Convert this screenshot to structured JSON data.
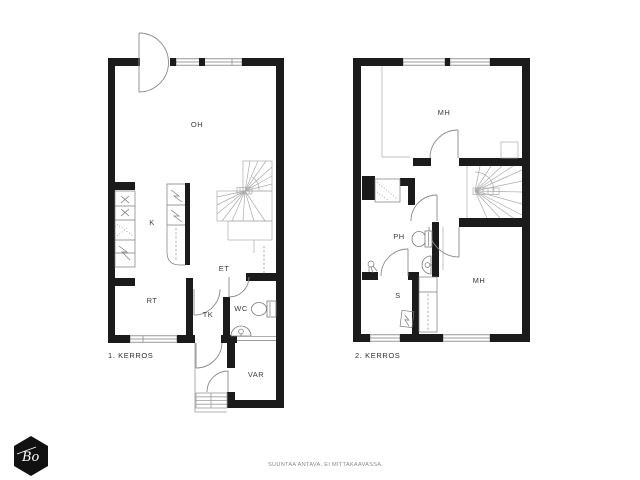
{
  "floor1": {
    "title": "1. KERROS",
    "rooms": {
      "oh": "OH",
      "k": "K",
      "et": "ET",
      "rt": "RT",
      "tk": "TK",
      "wc": "WC",
      "var": "VAR"
    }
  },
  "floor2": {
    "title": "2. KERROS",
    "rooms": {
      "mh_top": "MH",
      "ph": "PH",
      "s": "S",
      "mh_lower": "MH"
    }
  },
  "footer": {
    "disclaimer": "SUUNTAA ANTAVA, EI MITTAKAAVASSA.",
    "logo_text": "Bo"
  },
  "colors": {
    "wall": "#1b1b1b",
    "thin_line": "#9a9a9a",
    "label_text": "#3c3c3c",
    "footer_text": "#8a8a8a",
    "logo_background": "#111111",
    "background": "#ffffff"
  }
}
